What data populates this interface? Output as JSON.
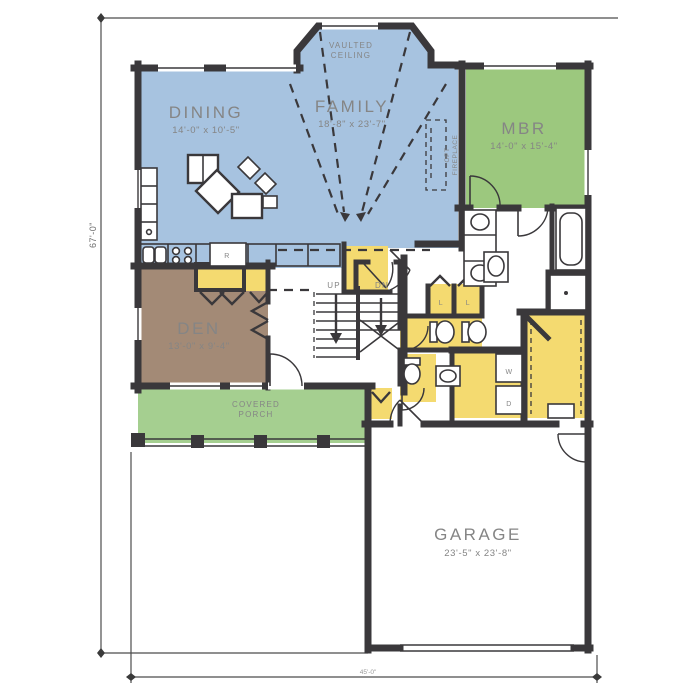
{
  "plan": {
    "rooms": {
      "dining": {
        "name": "DINING",
        "dims": "14'-0\" x 10'-5\""
      },
      "family": {
        "name": "FAMILY",
        "dims": "18'-8\" x 23'-7\"",
        "ceiling_note_line1": "VAULTED",
        "ceiling_note_line2": "CEILING"
      },
      "mbr": {
        "name": "MBR",
        "dims": "14'-0\" x 15'-4\""
      },
      "den": {
        "name": "DEN",
        "dims": "13'-0\" x 9'-4\""
      },
      "porch": {
        "name_line1": "COVERED",
        "name_line2": "PORCH"
      },
      "garage": {
        "name": "GARAGE",
        "dims": "23'-5\" x 23'-8\""
      }
    },
    "annotations": {
      "opt_fireplace_line1": "OPT",
      "opt_fireplace_line2": "FIREPLACE",
      "stairs_up": "UP",
      "stairs_down": "DN",
      "linen1": "L",
      "linen2": "L",
      "washer": "W",
      "dryer": "D",
      "refrigerator": "R"
    },
    "dimensions": {
      "left_overall": "67'-0\"",
      "bottom_overall": "45'-0\""
    },
    "colors": {
      "living_blue": "#a7c3e0",
      "bedroom_green": "#9cc87e",
      "porch_green": "#a5cf90",
      "den_brown": "#a38a76",
      "utility_yellow": "#f4da70",
      "wall": "#3a383b",
      "label_text": "#858585"
    }
  }
}
